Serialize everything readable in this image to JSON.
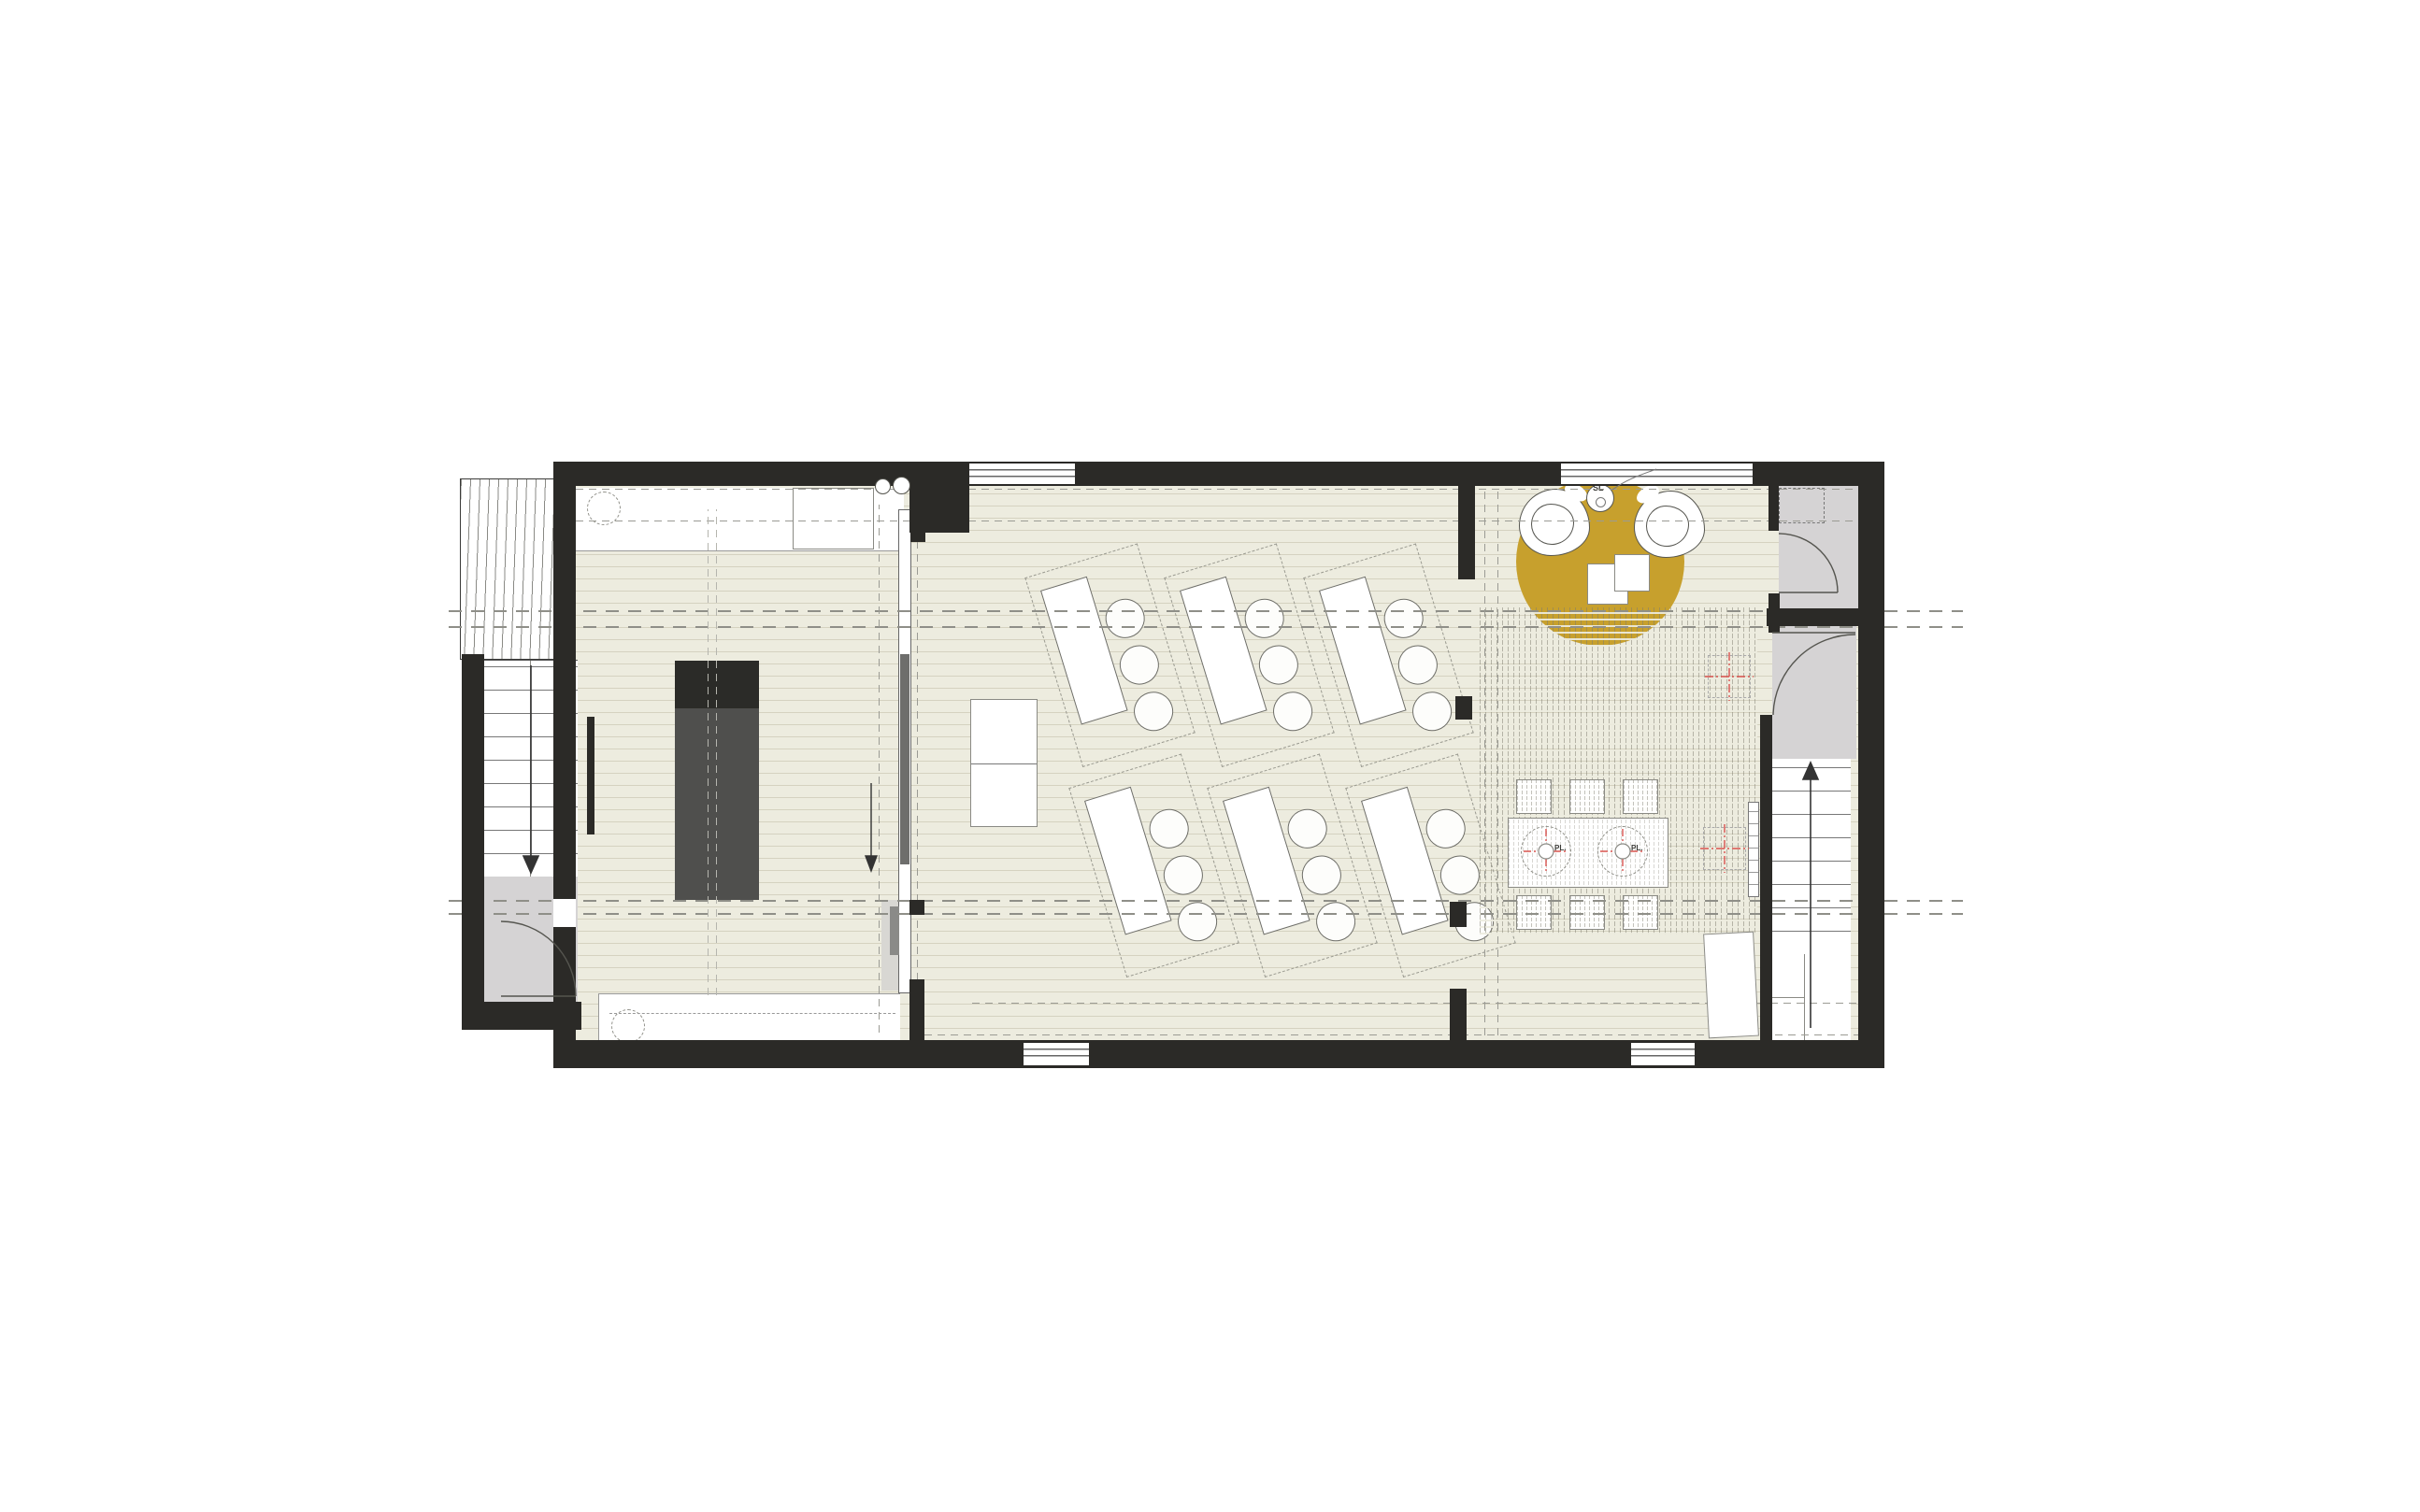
{
  "drawing": {
    "type": "architectural-floor-plan",
    "view": "top-down",
    "building": "single-storey office / studio floor with two stair towers"
  },
  "labels": {
    "side_table": "SL",
    "pendant_light": "PL."
  },
  "colors": {
    "wall_black": "#2b2a27",
    "floor_beige": "#edecdf",
    "plank_line": "#968e6e",
    "room_gray": "#d5d3d4",
    "accent_gold": "#c7a02d",
    "marker_red": "#d9534f",
    "dashed_gray": "#8f8f88"
  },
  "rooms": [
    {
      "name": "exterior-stair-tower-west",
      "features": [
        "ramp-hatch",
        "stair-run-down-arrow",
        "landing",
        "entrance-door-swing"
      ]
    },
    {
      "name": "kitchen-room-west",
      "features": [
        "upper-counter",
        "lower-counter",
        "dashed-circle-x2",
        "appliance-block",
        "twin-sinks",
        "dark-storage-volume",
        "sliding-door-partition-with-down-arrow"
      ]
    },
    {
      "name": "studio-room-center",
      "features": [
        "desk-groups-6",
        "chairs-3-per-desk",
        "dashed-desk-outlines",
        "white-cabinet-2-cell",
        "window-top",
        "window-bottom"
      ]
    },
    {
      "name": "lounge-room-east",
      "features": [
        "gold-round-rug",
        "lounge-chair-x2",
        "side-table-SL",
        "overlapping-square-tables-x2",
        "carpet-hatch-zone",
        "long-table",
        "stools-6",
        "pendant-light-markers-PL",
        "radiator",
        "open-door-leaf"
      ]
    },
    {
      "name": "wc-north-east",
      "features": [
        "door-swing",
        "dashed-skylight-square"
      ]
    },
    {
      "name": "wc-mid-east",
      "features": [
        "door-swing"
      ]
    },
    {
      "name": "stair-hall-east",
      "features": [
        "stair-run-up-arrow",
        "l-return-landing"
      ]
    }
  ],
  "annotations": {
    "reference_line_pairs": 2,
    "interior_dashed_lines": 4,
    "red_registration_crosses": 4,
    "window_count": 4
  }
}
